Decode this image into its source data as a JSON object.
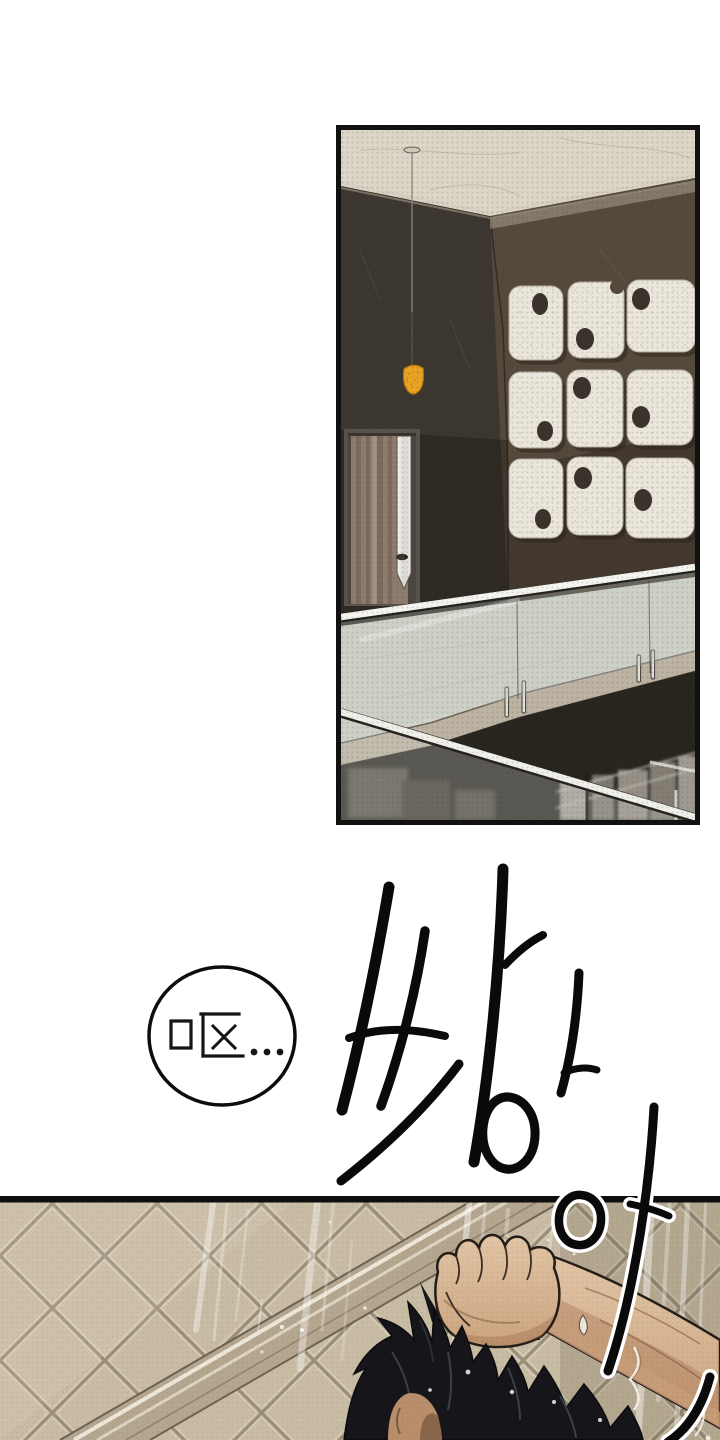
{
  "page": {
    "kind": "webtoon-comic-page",
    "background": "#ffffff",
    "width": 720,
    "height": 1440
  },
  "bubble": {
    "text": "呕...",
    "fill": "#ffffff",
    "stroke": "#0d0d0d"
  },
  "sfx": {
    "text": "싸아아",
    "color": "#0a0a0a",
    "outline": "#ffffff"
  },
  "panel_interior": {
    "name": "balcony-interior-panel",
    "border_color": "#111111",
    "colors": {
      "ceiling": "#DCD6C8",
      "wall_left": "#3B362F",
      "wall_right": "#55493C",
      "door_frame": "#57524A",
      "door_wood": "#8D7C6D",
      "lamp": "#E8A322",
      "plaque": "#EAE6DC",
      "plaque_hole": "#3A332B",
      "floor": "#D3D5CB",
      "fascia": "#BCB3A2",
      "void": "#28251F",
      "rail": "#F4F4F0"
    }
  },
  "panel_shower": {
    "name": "shower-scene-panel",
    "border_color": "#0E0E0E",
    "colors": {
      "tile": "#C9BCA4",
      "grout": "#9C8F7A",
      "band": "#B5A78F",
      "skin_shadow": "#C49A76",
      "hair": "#15151A",
      "water": "#FFFFFF"
    }
  }
}
